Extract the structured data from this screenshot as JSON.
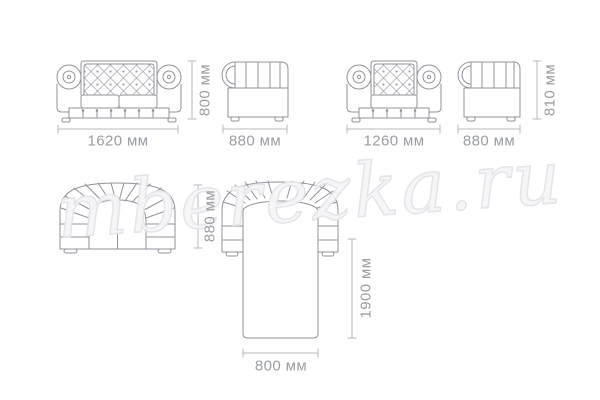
{
  "watermark": {
    "text": "mberezka.ru"
  },
  "colors": {
    "line": "#90939b",
    "dim": "#b7b9be",
    "label": "#9a9da3",
    "wm-fill": "#f6f6f8",
    "wm-stroke": "#e3e4e8"
  },
  "diagram": {
    "sofa_front": {
      "width": "1620 мм",
      "height": "800 мм"
    },
    "sofa_side": {
      "depth": "880 мм"
    },
    "armchair_front": {
      "width": "1260 мм"
    },
    "armchair_side": {
      "depth": "880 мм",
      "height": "810 мм"
    },
    "sofa_top": {
      "depth": "880 мм"
    },
    "sofa_bed_top": {
      "length": "1900 мм",
      "width": "800 мм"
    }
  }
}
